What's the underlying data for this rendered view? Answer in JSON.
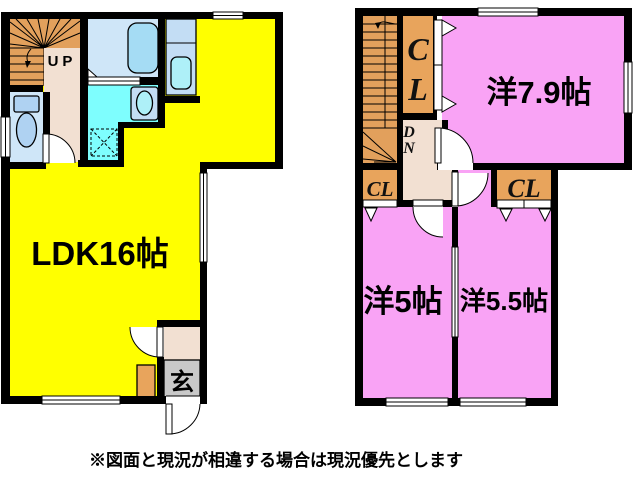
{
  "colors": {
    "wall": "#000000",
    "background": "#FFFFFF",
    "ldk_yellow": "#FFFF00",
    "room_pink": "#F9A3F5",
    "stairs_orange": "#E2A05C",
    "closet_orange": "#E8A45C",
    "hall_beige": "#F2E0D2",
    "bath_floor_blue": "#CFE6F8",
    "fixture_blue": "#AFD2F2",
    "bathtub_blue": "#A5DCF4",
    "counter_blue": "#C3DDF4",
    "sink_cyan": "#AEF0F8",
    "washroom_cyan": "#7EFEFE",
    "genkan_gray": "#C9C9C9"
  },
  "floor1": {
    "stairs_label": "UP",
    "ldk_label": "LDK16帖",
    "genkan_label": "玄"
  },
  "floor2": {
    "room_79_label": "洋7.9帖",
    "room_5_label": "洋5帖",
    "room_55_label": "洋5.5帖",
    "closet_tall": {
      "letter_top": "C",
      "letter_bottom": "L"
    },
    "closet_left_label": "CL",
    "closet_right_label": "CL",
    "stairs_down": {
      "letter_top": "D",
      "letter_bottom": "N"
    }
  },
  "footer": {
    "note": "※図面と現況が相違する場合は現況優先とします"
  }
}
